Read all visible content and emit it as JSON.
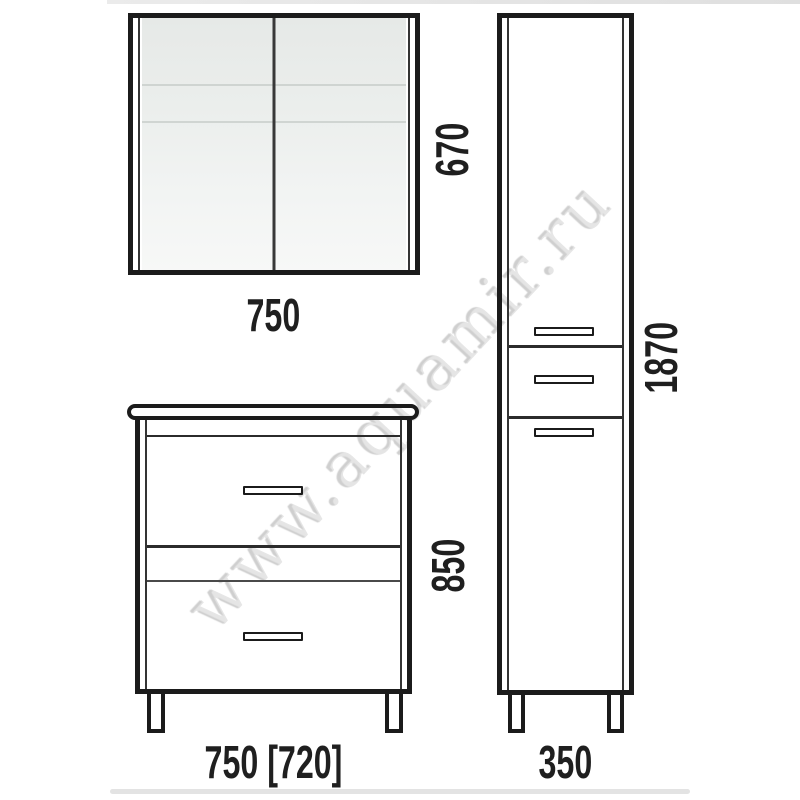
{
  "diagram": {
    "watermark": "www.aquamir.ru",
    "mirror_cabinet": {
      "width_label": "750",
      "height_label": "670"
    },
    "vanity_unit": {
      "width_label": "750 [720]",
      "height_label": "850"
    },
    "tall_cabinet": {
      "width_label": "350",
      "height_label": "1870"
    },
    "colors": {
      "line": "#1b1b1b",
      "mirror_fill_top": "#e6e9e7",
      "mirror_fill_bottom": "#f7f8f7",
      "watermark_gray": "#cecece",
      "background": "#ffffff"
    }
  }
}
